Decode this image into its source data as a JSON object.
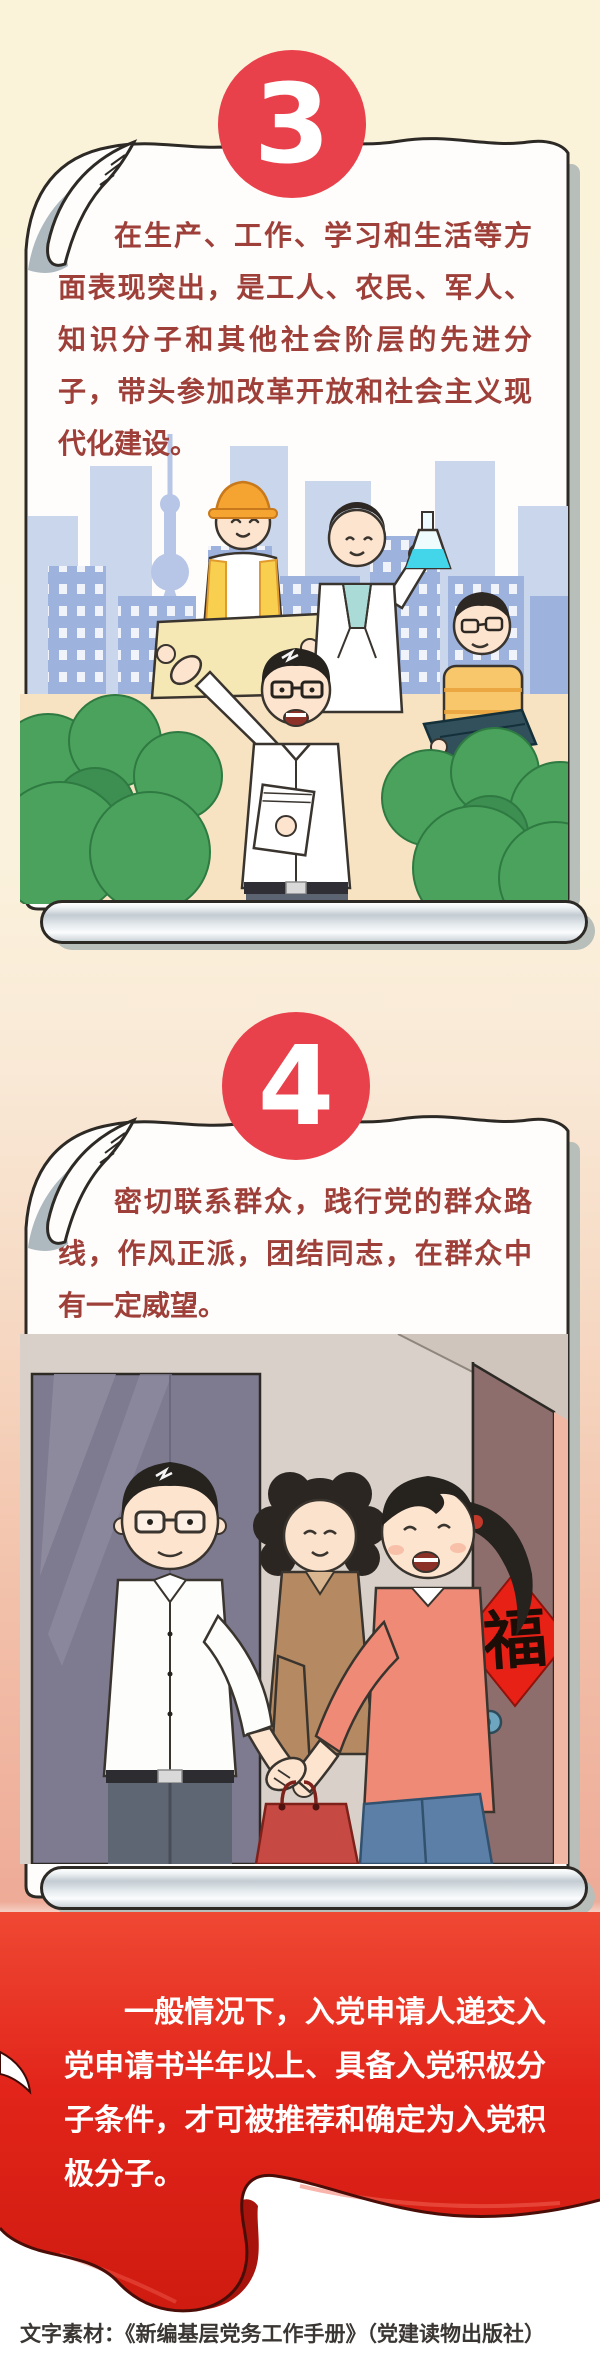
{
  "page": {
    "background_top": "#faf3da",
    "background_pink": "#eeab97",
    "accent_red": "#e8414b",
    "paragraph_red": "#9e4039",
    "flag_red": "#e2241a",
    "paper_white": "#fefdfb"
  },
  "sections": [
    {
      "number": "3",
      "paragraph": "在生产、工作、学习和生活等方面表现突出，是工人、农民、军人、知识分子和其他社会阶层的先进分子，带头参加改革开放和社会主义现代化建设。",
      "illustration": "city-skyline-worker-scientist-office-workers-scene"
    },
    {
      "number": "4",
      "paragraph": "密切联系群众，践行党的群众路线，作风正派，团结同志，在群众中有一定威望。",
      "door_sign": "福",
      "illustration": "home-visit-handshake-at-door-scene"
    }
  ],
  "banner": {
    "paragraph": "一般情况下，入党申请人递交入党申请书半年以上、具备入党积极分子条件，才可被推荐和确定为入党积极分子。"
  },
  "footer": {
    "source": "文字素材：《新编基层党务工作手册》（党建读物出版社）"
  }
}
